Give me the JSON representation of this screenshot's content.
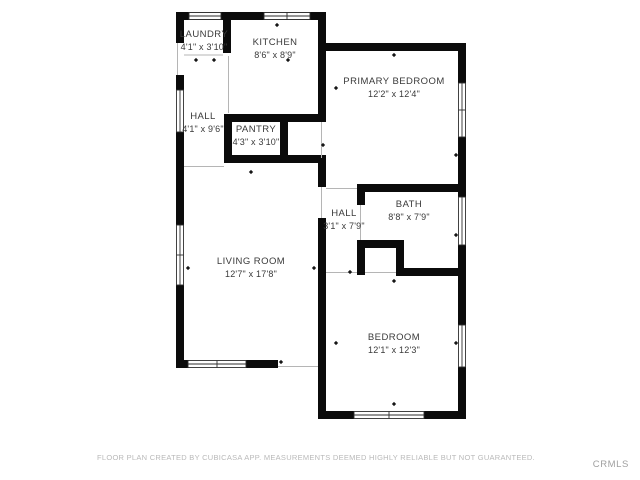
{
  "plan": {
    "rooms": [
      {
        "name": "LAUNDRY",
        "dims": "4'1\" x 3'10\""
      },
      {
        "name": "KITCHEN",
        "dims": "8'6\" x 8'9\""
      },
      {
        "name": "PRIMARY BEDROOM",
        "dims": "12'2\" x 12'4\""
      },
      {
        "name": "HALL",
        "dims": "4'1\" x 9'6\""
      },
      {
        "name": "PANTRY",
        "dims": "4'3\" x 3'10\""
      },
      {
        "name": "HALL",
        "dims": "3'1\" x 7'9\""
      },
      {
        "name": "BATH",
        "dims": "8'8\" x 7'9\""
      },
      {
        "name": "LIVING ROOM",
        "dims": "12'7\" x 17'8\""
      },
      {
        "name": "BEDROOM",
        "dims": "12'1\" x 12'3\""
      }
    ],
    "wall_color": "#0b0b0b",
    "label_color": "#3a3a3a"
  },
  "footer": {
    "disclaimer": "FLOOR PLAN CREATED BY CUBICASA APP. MEASUREMENTS DEEMED HIGHLY RELIABLE BUT NOT GUARANTEED.",
    "watermark": "CRMLS"
  }
}
